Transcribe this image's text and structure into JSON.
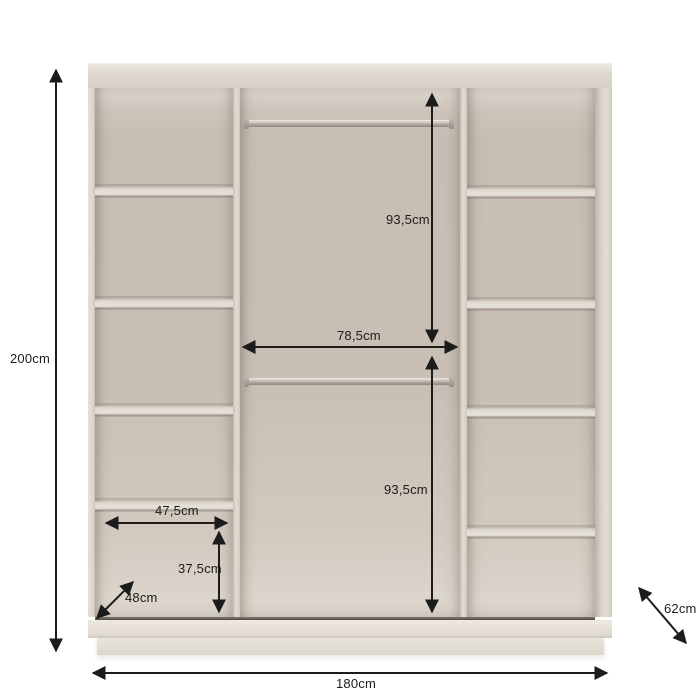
{
  "figure": {
    "title": "Wardrobe interior dimension diagram",
    "colors": {
      "background": "#ffffff",
      "cabinet": "#ddd6cd",
      "interior_back": "#c8beb4",
      "dimension_line": "#1c1c1c"
    }
  },
  "dimensions": {
    "overall_height": "200cm",
    "overall_width": "180cm",
    "depth": "62cm",
    "upper_hanging_height": "93,5cm",
    "lower_hanging_height": "93,5cm",
    "hanging_section_width": "78,5cm",
    "shelf_width": "47,5cm",
    "bottom_compartment_height": "37,5cm",
    "shelf_depth": "48cm"
  }
}
